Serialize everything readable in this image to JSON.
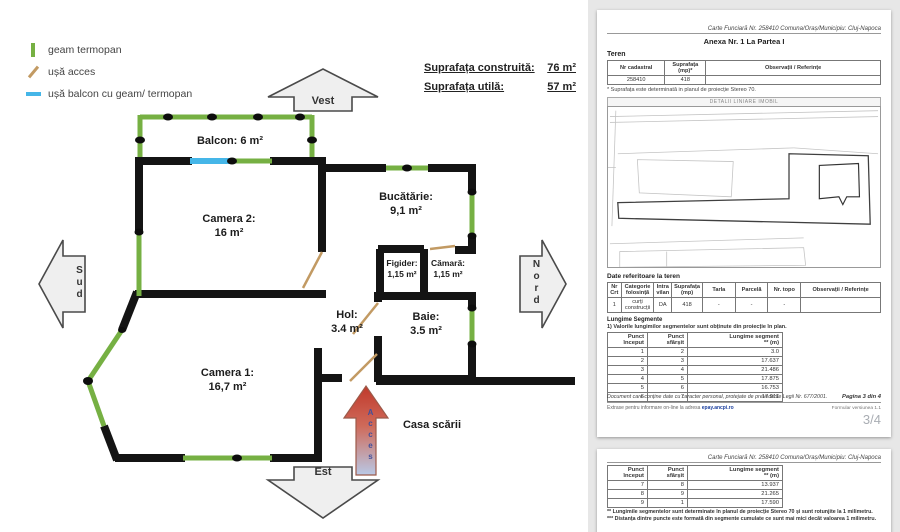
{
  "floorplan": {
    "legend": {
      "items": [
        {
          "icon": "window-green-swatch",
          "label": "geam termopan"
        },
        {
          "icon": "door-tan-swatch",
          "label": "ușă acces"
        },
        {
          "icon": "balcony-door-blue-swatch",
          "label": "ușă balcon cu geam/ termopan"
        }
      ]
    },
    "areas": {
      "built_label": "Suprafața construită:",
      "built_value": "76 m²",
      "usable_label": "Suprafața utilă:",
      "usable_value": "57 m²"
    },
    "compass": {
      "west": "Vest",
      "south": "Sud",
      "north": "Nord",
      "east": "Est"
    },
    "rooms": {
      "balcon": {
        "l1": "Balcon: 6 m²",
        "l2": ""
      },
      "camera2": {
        "l1": "Camera 2:",
        "l2": "16 m²"
      },
      "bucatarie": {
        "l1": "Bucătărie:",
        "l2": "9,1 m²"
      },
      "figider": {
        "l1": "Figider:",
        "l2": "1,15 m²"
      },
      "camara": {
        "l1": "Cămară:",
        "l2": "1,15 m²"
      },
      "hol": {
        "l1": "Hol:",
        "l2": "3.4 m²"
      },
      "baie": {
        "l1": "Baie:",
        "l2": "3.5 m²"
      },
      "camera1": {
        "l1": "Camera 1:",
        "l2": "16,7 m²"
      }
    },
    "stairs_label": "Casa scării",
    "access_label": "Acces",
    "colors": {
      "window_green": "#76b043",
      "balcony_door_blue": "#45b6e8",
      "door_tan": "#c29a63",
      "wall_black": "#141414",
      "access_arrow_red": "#c0392b"
    }
  },
  "document": {
    "page3": {
      "header": "Carte Funciară Nr. 258410 Comuna/Oraș/Municipiu: Cluj-Napoca",
      "anexa_title": "Anexa Nr. 1 La Partea I",
      "teren_heading": "Teren",
      "teren_table": {
        "h_nr": "Nr cadastral",
        "h_sup": "Suprafața (mp)*",
        "h_obs": "Observații / Referințe",
        "nr": "258410",
        "sup": "418",
        "obs": ""
      },
      "note": "* Suprafața este determinată in planul de proiecție Stereo 70.",
      "detail_banner": "DETALII LINIARE IMOBIL",
      "date_heading": "Date referitoare la teren",
      "date_table": {
        "headers": [
          "Nr Crt",
          "Categorie folosință",
          "Intra vilan",
          "Suprafața (mp)",
          "Tarla",
          "Parcelă",
          "Nr. topo",
          "Observații / Referințe"
        ],
        "row": [
          "1",
          "curți construcții",
          "DA",
          "418",
          "-",
          "-",
          "-",
          ""
        ]
      },
      "lungime_heading": "Lungime Segmente",
      "lungime_note": "1) Valorile lungimilor segmentelor sunt obținute din proiecție în plan.",
      "seg_h_start": "Punct început",
      "seg_h_end": "Punct sfârșit",
      "seg_h_len": "Lungime segment",
      "seg_h_len2": "** (m)",
      "seg_rows": [
        [
          "1",
          "2",
          "3.0"
        ],
        [
          "2",
          "3",
          "17.637"
        ],
        [
          "3",
          "4",
          "21.486"
        ],
        [
          "4",
          "5",
          "17.875"
        ],
        [
          "5",
          "6",
          "16.753"
        ],
        [
          "6",
          "7",
          "17.911"
        ]
      ],
      "footer_privacy": "Document care conține date cu caracter personal, protejate de prevederile Legii Nr. 677/2001.",
      "footer_page": "Pagina 3 din 4",
      "footer_extract": "Extrase pentru informare on-line la adresa",
      "footer_link": "epay.ancpi.ro",
      "footer_version": "Formular versiunea 1.1",
      "page_badge": "3/4"
    },
    "page4": {
      "header": "Carte Funciară Nr. 258410 Comuna/Oraș/Municipiu: Cluj-Napoca",
      "seg_rows": [
        [
          "7",
          "8",
          "13.937"
        ],
        [
          "8",
          "9",
          "21.265"
        ],
        [
          "9",
          "1",
          "17.590"
        ]
      ],
      "footnote_a": "** Lungimile segmentelor sunt determinate în planul de proiecție Stereo 70 și sunt rotunjite la 1 milimetru.",
      "footnote_b": "*** Distanța dintre puncte este formată din segmente cumulate ce sunt mai mici decât valoarea 1 milimetru."
    }
  }
}
